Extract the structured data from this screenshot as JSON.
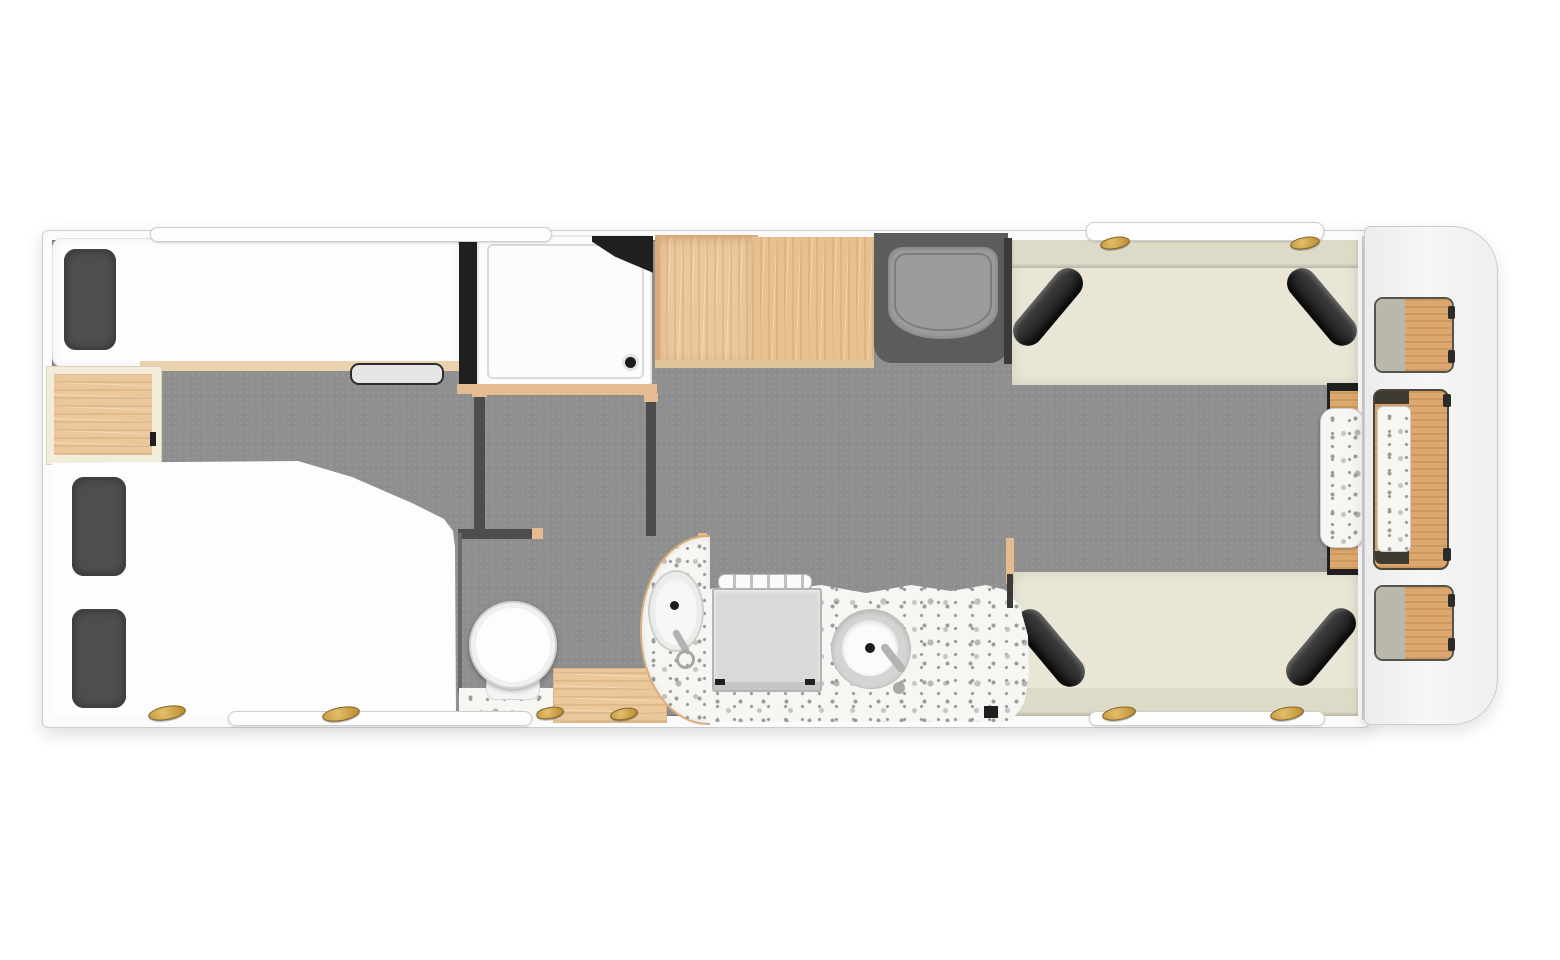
{
  "plan": {
    "kind": "caravan-floorplan-top-view",
    "regions": [
      {
        "name": "bedroom-left",
        "items": [
          "single-bed",
          "single-bed-pillow",
          "double-bed",
          "double-bed-pillow-top",
          "double-bed-pillow-bottom",
          "bedside-chest",
          "under-bed-step-handle"
        ]
      },
      {
        "name": "shower-room",
        "items": [
          "shower-tray",
          "folded-shower-door",
          "shower-drain"
        ]
      },
      {
        "name": "wardrobe-units",
        "items": [
          "open-wardrobe",
          "worktop-cabinet"
        ]
      },
      {
        "name": "entrance",
        "items": [
          "door-recess",
          "entry-mat"
        ]
      },
      {
        "name": "washroom",
        "items": [
          "toilet",
          "washbasin",
          "basin-tap",
          "basin-counter",
          "wood-floor-mat",
          "terrazzo-floor-patch"
        ]
      },
      {
        "name": "kitchen",
        "items": [
          "terrazzo-worktop",
          "hob",
          "hob-pan-rail",
          "round-sink",
          "sink-tap",
          "power-socket"
        ]
      },
      {
        "name": "lounge",
        "items": [
          "top-bench",
          "bottom-bench",
          "bolster-cushion-top-left",
          "bolster-cushion-top-right",
          "bolster-cushion-bottom-left",
          "bolster-cushion-bottom-right",
          "side-table",
          "overhead-window-panel"
        ]
      },
      {
        "name": "front-pod",
        "items": [
          "pod-chair-top",
          "pod-table",
          "pod-chair-bottom"
        ]
      }
    ],
    "hinge_count": 8,
    "window_bar_count": 3
  },
  "colors": {
    "page_bg": "#ffffff",
    "wall_white": "#fbfbfb",
    "floor_gray": "#8f8f8f",
    "recess_gray": "#5c5c5c",
    "partition_dark": "#4d4d4d",
    "wall_black": "#1f1f1f",
    "wood_light": "#ecc79b",
    "wood_mid": "#e5bc90",
    "wood_warm": "#dda86f",
    "bed_white": "#fdfdfd",
    "pillow_gray": "#4e4e4e",
    "bench_cream": "#e9e6d6",
    "bench_cream_dark": "#dedac8",
    "cushion_black": "#2d2d2d",
    "terrazzo_base": "#f6f6f3",
    "appliance_gray": "#d9d9d9",
    "sage": "#b9b8ab",
    "hinge_gold": "#c69a3e",
    "outline": "#cccccc"
  }
}
